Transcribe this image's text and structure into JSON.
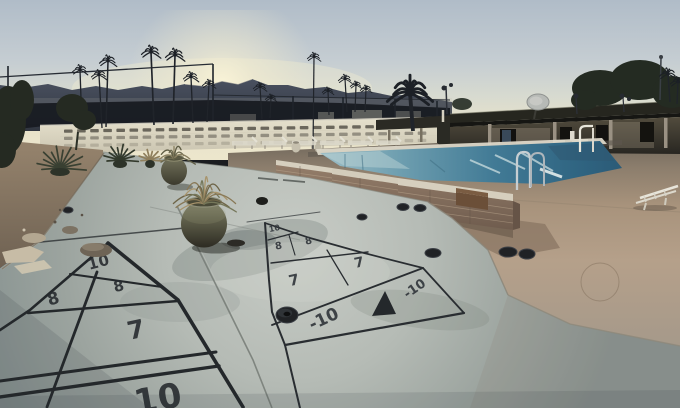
{
  "meta": {
    "description": "Outdoor photo at dusk: two etched shuffleboard courts on a concrete deck beside a swimming pool, with palm trees, mountains, a cream slotted block wall, a clubhouse pavilion and desert landscaping.",
    "time_of_day": "sunset"
  },
  "palette": {
    "sky_top": "#b0bcc8",
    "sky_horizon": "#ece6cc",
    "sun_glow": "#fbf5d8",
    "mountains": "#3d4450",
    "privacy_wall": "#e0dbc7",
    "pool_water_deep": "#2b5a76",
    "pool_water_light": "#a9c6cc",
    "brick_wall": "#8a7464",
    "court_slab": "#aab1ab",
    "deck_tan": "#b19d85",
    "court_lines": "#24282b"
  },
  "courts": {
    "near": {
      "labels": [
        "10",
        "8",
        "8",
        "7",
        "10"
      ]
    },
    "far": {
      "labels": [
        "10",
        "8",
        "8",
        "7",
        "7",
        "-10",
        "-10"
      ]
    }
  },
  "scene_objects": {
    "palms": [
      {
        "x": 80,
        "top": 70,
        "base": 127,
        "r": 8,
        "lean": -2
      },
      {
        "x": 99,
        "top": 75,
        "base": 128,
        "r": 8,
        "lean": -3
      },
      {
        "x": 108,
        "top": 61,
        "base": 127,
        "r": 9,
        "lean": 2
      },
      {
        "x": 151,
        "top": 52,
        "base": 125,
        "r": 10,
        "lean": -3
      },
      {
        "x": 175,
        "top": 55,
        "base": 124,
        "r": 10,
        "lean": 2
      },
      {
        "x": 191,
        "top": 77,
        "base": 123,
        "r": 8,
        "lean": -2
      },
      {
        "x": 209,
        "top": 84,
        "base": 122,
        "r": 7,
        "lean": 2
      },
      {
        "x": 260,
        "top": 87,
        "base": 119,
        "r": 7,
        "lean": -2
      },
      {
        "x": 271,
        "top": 98,
        "base": 118,
        "r": 6,
        "lean": 1
      },
      {
        "x": 314,
        "top": 57,
        "base": 150,
        "r": 7,
        "lean": 1
      },
      {
        "x": 328,
        "top": 91,
        "base": 115,
        "r": 6,
        "lean": -1
      },
      {
        "x": 345,
        "top": 79,
        "base": 112,
        "r": 7,
        "lean": -2
      },
      {
        "x": 356,
        "top": 85,
        "base": 112,
        "r": 6,
        "lean": 1
      },
      {
        "x": 366,
        "top": 89,
        "base": 112,
        "r": 6,
        "lean": 1
      },
      {
        "x": 410,
        "top": 93,
        "base": 131,
        "r": 23,
        "lean": -3
      },
      {
        "x": 668,
        "top": 74,
        "base": 102,
        "r": 9,
        "lean": -2
      },
      {
        "x": 678,
        "top": 82,
        "base": 104,
        "r": 8,
        "lean": 1
      }
    ],
    "discs": [
      {
        "x": 68,
        "y": 210,
        "rx": 5,
        "ry": 3
      },
      {
        "x": 362,
        "y": 217,
        "rx": 5,
        "ry": 3
      },
      {
        "x": 403,
        "y": 207,
        "rx": 6,
        "ry": 3.5
      },
      {
        "x": 420,
        "y": 208,
        "rx": 6,
        "ry": 3.5
      },
      {
        "x": 433,
        "y": 253,
        "rx": 8,
        "ry": 4.5
      },
      {
        "x": 508,
        "y": 252,
        "rx": 9,
        "ry": 5
      },
      {
        "x": 527,
        "y": 254,
        "rx": 8,
        "ry": 5
      },
      {
        "x": 287,
        "y": 315,
        "rx": 11,
        "ry": 8,
        "puck": true
      }
    ],
    "chairs": {
      "xs": [
        232,
        262,
        292,
        320,
        348,
        376
      ]
    },
    "wall": {
      "slats": 28
    },
    "pot_plants": {
      "large": {
        "cx": 204,
        "cy": 204,
        "n": 16,
        "len": 40
      },
      "small": {
        "cx": 174,
        "cy": 159,
        "n": 9,
        "len": 22
      }
    }
  }
}
